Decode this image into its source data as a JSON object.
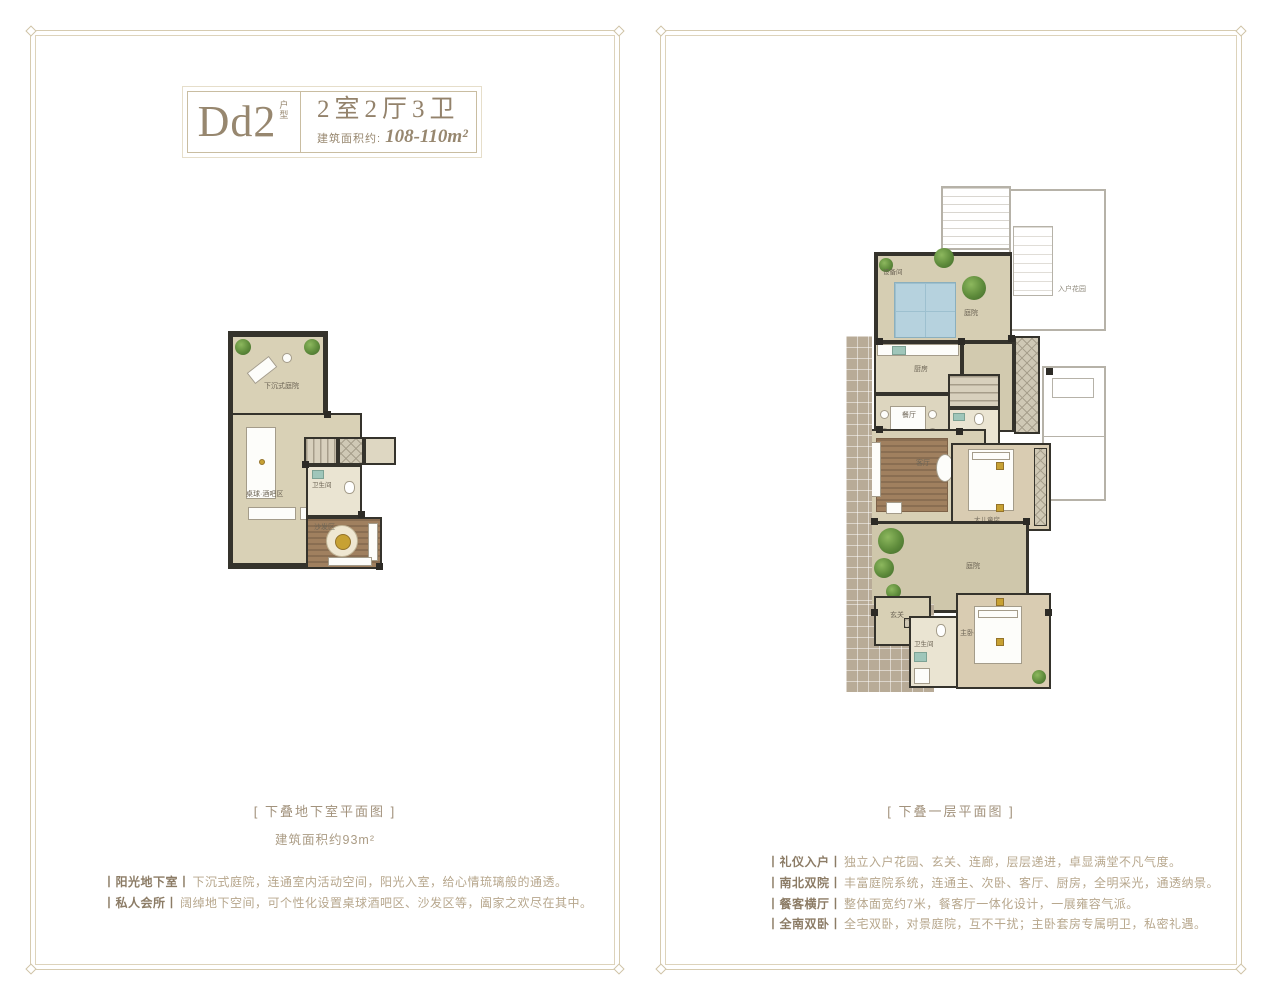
{
  "header": {
    "unit_code": "Dd2",
    "unit_tag": "户型",
    "layout_spec": "2室2厅3卫",
    "area_label": "建筑面积约:",
    "area_value": "108-110m²"
  },
  "left_panel": {
    "caption": "[ 下叠地下室平面图 ]",
    "area_note": "建筑面积约93m²",
    "features": [
      {
        "title": "丨阳光地下室丨",
        "text": "下沉式庭院，连通室内活动空间，阳光入室，给心情琉璃般的通透。"
      },
      {
        "title": "丨私人会所丨",
        "text": "阔绰地下空间，可个性化设置桌球酒吧区、沙发区等，阖家之欢尽在其中。"
      }
    ],
    "rooms": {
      "courtyard": "下沉式庭院",
      "billiard": "桌球·酒吧区",
      "bath": "卫生间",
      "sofa": "沙发区"
    }
  },
  "right_panel": {
    "caption": "[ 下叠一层平面图 ]",
    "features": [
      {
        "title": "丨礼仪入户丨",
        "text": "独立入户花园、玄关、连廊，层层递进，卓显满堂不凡气度。"
      },
      {
        "title": "丨南北双院丨",
        "text": "丰富庭院系统，连通主、次卧、客厅、厨房，全明采光，通透纳景。"
      },
      {
        "title": "丨餐客横厅丨",
        "text": "整体面宽约7米，餐客厅一体化设计，一展雍容气派。"
      },
      {
        "title": "丨全南双卧丨",
        "text": "全宅双卧，对景庭院，互不干扰；主卧套房专属明卫，私密礼遇。"
      }
    ],
    "rooms": {
      "equipment": "设备间",
      "north_yard": "庭院",
      "entry_garden": "入户花园",
      "kitchen": "厨房",
      "dining": "餐厅",
      "bath1": "卫生间",
      "living": "客厅",
      "kids": "大儿童房",
      "south_yard": "庭院",
      "foyer": "玄关",
      "master": "主卧",
      "bath2": "卫生间"
    }
  }
}
